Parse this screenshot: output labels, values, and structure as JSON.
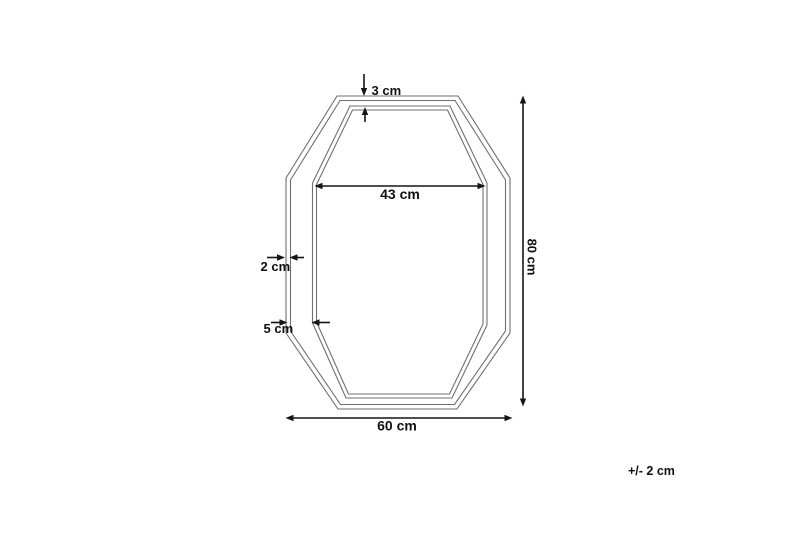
{
  "diagram": {
    "labels": {
      "top_gap": "3 cm",
      "inner_width": "43 cm",
      "frame_thickness": "2 cm",
      "frame_border": "5 cm",
      "overall_height": "80 cm",
      "overall_width": "60 cm",
      "tolerance": "+/- 2 cm"
    },
    "colors": {
      "background": "#ffffff",
      "frame_outline": "#6f6f6f",
      "dimension_lines": "#151515",
      "label_text": "#111111"
    }
  }
}
